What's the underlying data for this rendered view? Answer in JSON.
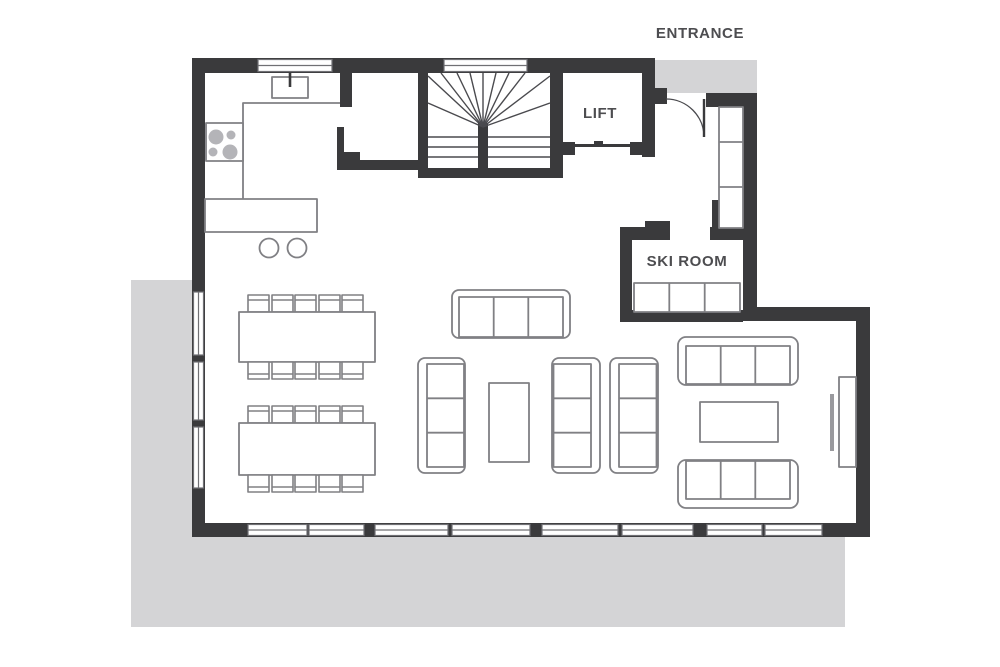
{
  "labels": {
    "entrance": "ENTRANCE",
    "lift": "LIFT",
    "ski_room": "SKI ROOM"
  },
  "colors": {
    "wall": "#3a3a3c",
    "furniture_stroke": "#808084",
    "thin_line": "#8a8a8e",
    "stair_line": "#4a4a4e",
    "terrace": "#d4d4d6",
    "window_frame": "#707074",
    "label_text": "#4d4d50",
    "burner": "#b4b4b8",
    "tv": "#9a9a9e",
    "background": "#ffffff"
  },
  "plan_summary": {
    "type": "floor-plan",
    "rooms_labeled": [
      "ENTRANCE",
      "LIFT",
      "SKI ROOM"
    ],
    "dining_tables": 2,
    "seats_per_table": 10,
    "sofas_three_seat": 6,
    "coffee_tables": 2,
    "bar_stools": 2,
    "stove_burners": 4,
    "ski_bench_sections": 3,
    "wardrobe_sections": 3,
    "terrace_sides": [
      "south",
      "west"
    ],
    "staircase": "winder with central newel",
    "kitchen_features": [
      "sink",
      "stove",
      "island"
    ]
  }
}
